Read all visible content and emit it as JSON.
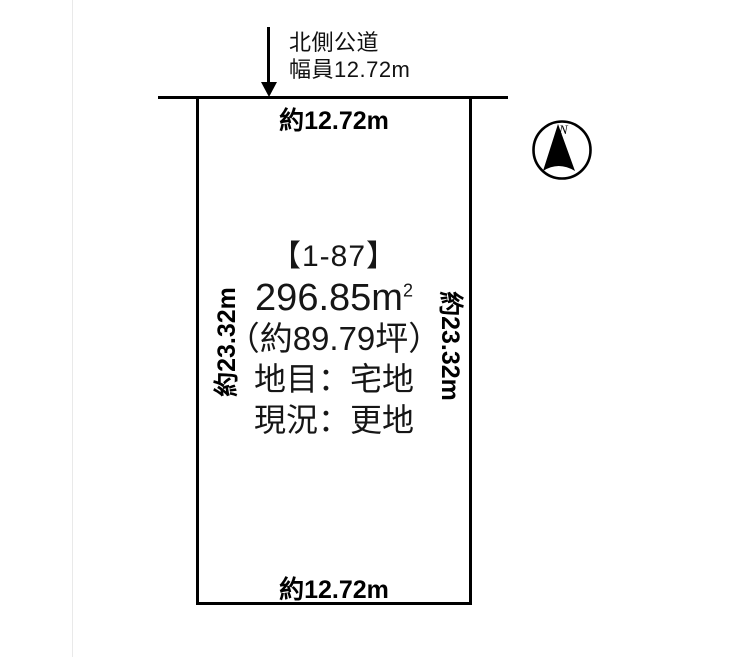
{
  "road": {
    "label_line1": "北側公道",
    "label_line2": "幅員12.72m"
  },
  "plot": {
    "parcel_id": "【1-87】",
    "area_value": "296.85m",
    "area_sup": "2",
    "area_tsubo": "（約89.79坪）",
    "land_category": "地目：宅地",
    "current_state": "現況：更地",
    "dim_top": "約12.72m",
    "dim_bottom": "約12.72m",
    "dim_left": "約23.32m",
    "dim_right": "約23.32m"
  },
  "compass": {
    "north_label": "N"
  },
  "colors": {
    "line": "#000000",
    "text": "#111111",
    "page_edge": "#e9e9e9",
    "background": "#ffffff"
  }
}
